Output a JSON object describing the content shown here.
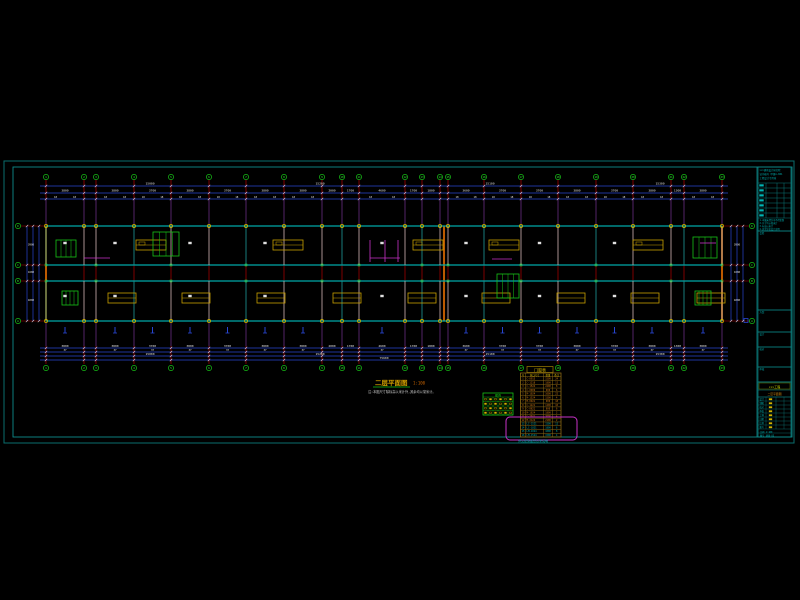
{
  "colors": {
    "bg": "#000000",
    "frame_outer": "#0a6e6e",
    "frame_inner": "#0d8c8c",
    "cyan": "#00b4b4",
    "wall": "#00a8a8",
    "green": "#17c417",
    "bright_green": "#3ae03a",
    "red_grid": "#b40000",
    "blue_dim": "#2846d2",
    "white": "#e0e0e0",
    "orange": "#d26400",
    "yellow": "#d2b400",
    "magenta": "#c832c8",
    "gray_col": "#b4b4b4",
    "teal_col": "#009a9a",
    "olive": "#8b6914",
    "schedule_text": "#d27814",
    "highlight": "#c832c8"
  },
  "grid": {
    "cols": [
      46,
      84,
      96,
      134,
      171,
      209,
      246,
      284,
      322,
      342,
      359,
      405,
      422,
      440,
      448,
      484,
      521,
      558,
      596,
      633,
      671,
      684,
      722
    ],
    "col_labels": [
      "1",
      "2",
      "3",
      "4",
      "5",
      "6",
      "7",
      "8",
      "9",
      "10",
      "11",
      "12",
      "13",
      "14",
      "15",
      "16",
      "17",
      "18",
      "19",
      "20",
      "21",
      "22",
      "23"
    ],
    "rows": [
      226,
      265,
      281,
      321
    ],
    "row_labels": [
      "D",
      "C",
      "B",
      "A"
    ],
    "expansion_joint_x": 444
  },
  "dims": {
    "bay": [
      "3800",
      "1200",
      "3800",
      "3700",
      "3800",
      "3700",
      "3800",
      "3800",
      "2000",
      "1700",
      "4600",
      "1700",
      "1800",
      "800",
      "3600",
      "3700",
      "3700",
      "3800",
      "3700",
      "3800",
      "1300",
      "3800"
    ],
    "top_totals": [
      "15000",
      "15200",
      "15100",
      "15300"
    ],
    "bottom_totals": [
      "15000",
      "15200",
      "15100",
      "15300"
    ],
    "grand_total": "75600",
    "row_dims": [
      "3900",
      "1600",
      "4000"
    ],
    "row_total": "9500"
  },
  "annotations": {
    "title": "二层平面图",
    "scale": "1:100",
    "note": "注:本图尺寸除标高以米计外,其余均以毫米计。",
    "footer_text": "详见建施图纸目录说明"
  },
  "legend_table": {
    "title": "图例",
    "rows": 4,
    "cols": 6
  },
  "schedule_table": {
    "title": "门窗表",
    "headers": [
      "号",
      "洞口尺寸",
      "数量",
      "备注"
    ],
    "rows": [
      {
        "idx": "1",
        "code": "C-0915",
        "size": "1500",
        "qty": "24",
        "color": "orange"
      },
      {
        "idx": "2",
        "code": "C-1218",
        "size": "1800",
        "qty": "12",
        "color": "orange"
      },
      {
        "idx": "3",
        "code": "C-1524",
        "size": "2400",
        "qty": "8",
        "color": "orange"
      },
      {
        "idx": "4",
        "code": "C-0909",
        "size": "900",
        "qty": "6",
        "color": "orange"
      },
      {
        "idx": "5",
        "code": "M-1024",
        "size": "1000",
        "qty": "22",
        "color": "orange"
      },
      {
        "idx": "6",
        "code": "M-1524",
        "size": "1500",
        "qty": "4",
        "color": "orange"
      },
      {
        "idx": "7",
        "code": "M-0921",
        "size": "900",
        "qty": "18",
        "color": "orange"
      },
      {
        "idx": "8",
        "code": "C-1221",
        "size": "1200",
        "qty": "10",
        "color": "orange"
      },
      {
        "idx": "9",
        "code": "C-0621",
        "size": "600",
        "qty": "6",
        "color": "orange"
      },
      {
        "idx": "10",
        "code": "M-1824",
        "size": "1800",
        "qty": "2",
        "color": "orange"
      },
      {
        "idx": "11",
        "code": "C-3021",
        "size": "3000",
        "qty": "4",
        "color": "orange"
      },
      {
        "idx": "12",
        "code": "M-2124",
        "size": "2100",
        "qty": "2",
        "color": "orange"
      },
      {
        "idx": "13",
        "code": "LC-1521",
        "size": "1500",
        "qty": "12",
        "color": "cyan"
      },
      {
        "idx": "14",
        "code": "LC-1821",
        "size": "1800",
        "qty": "6",
        "color": "cyan"
      },
      {
        "idx": "15",
        "code": "LM-1024",
        "size": "1000",
        "qty": "8",
        "color": "cyan"
      },
      {
        "idx": "16",
        "code": "LM-1524",
        "size": "1500",
        "qty": "4",
        "color": "cyan"
      }
    ]
  },
  "title_block": {
    "header_lines": [
      "×××建筑设计研究院",
      "证书编号 甲级A-001",
      "工程设计专用章"
    ],
    "note_lines": [
      "1.本图未经许可不得复制",
      "2.尺寸均以毫米计",
      "3.标高以米计",
      "4.其余详见设计说明"
    ],
    "signature_boxes": [
      "会签",
      "方案",
      "设计",
      "校对",
      "审核"
    ],
    "project_name": "×××工程",
    "drawing_name": "二层平面图",
    "info_rows": [
      "设计",
      "制图",
      "校对",
      "审核",
      "工种",
      "日期",
      "比例",
      "图号"
    ],
    "scale_text": "比例 1:100",
    "number_text": "图号 建施-05"
  }
}
